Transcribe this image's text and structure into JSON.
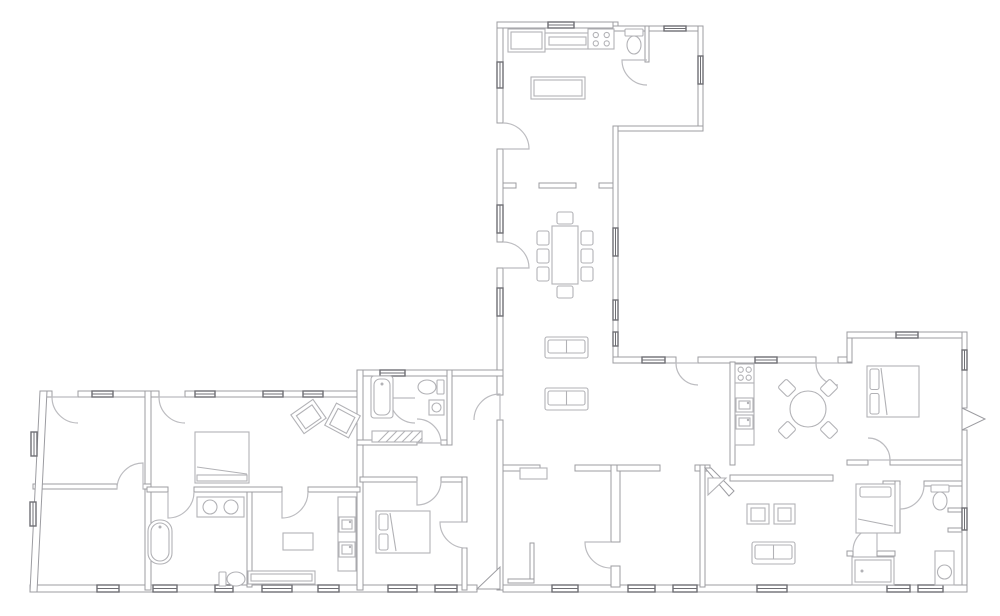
{
  "canvas": {
    "w": 1000,
    "h": 616,
    "bg": "#ffffff"
  },
  "style": {
    "wall_stroke": "#9c9ca1",
    "wall_fill": "#ffffff",
    "window_stroke": "#6f6f74",
    "door_stroke": "#bcbcc0",
    "furn_stroke": "#b2b2b6",
    "furn_fill": "#ffffff"
  },
  "walls": [
    {
      "x": 497,
      "y": 22,
      "w": 6,
      "h": 101,
      "n": "wing-left-a"
    },
    {
      "x": 497,
      "y": 149,
      "w": 6,
      "h": 93,
      "n": "wing-left-b"
    },
    {
      "x": 497,
      "y": 268,
      "w": 6,
      "h": 127,
      "n": "wing-left-c"
    },
    {
      "x": 497,
      "y": 420,
      "w": 6,
      "h": 170,
      "n": "wing-left-d"
    },
    {
      "x": 497,
      "y": 22,
      "w": 121,
      "h": 6,
      "n": "kitchen-top"
    },
    {
      "x": 613,
      "y": 22,
      "w": 5,
      "h": 9,
      "n": "kitchen-right-stub"
    },
    {
      "x": 613,
      "y": 26,
      "w": 90,
      "h": 5,
      "n": "annex-top"
    },
    {
      "x": 698,
      "y": 26,
      "w": 5,
      "h": 105,
      "n": "annex-right"
    },
    {
      "x": 613,
      "y": 126,
      "w": 90,
      "h": 5,
      "n": "annex-bottom"
    },
    {
      "x": 613,
      "y": 126,
      "w": 5,
      "h": 236,
      "n": "wing-right"
    },
    {
      "x": 613,
      "y": 357,
      "w": 63,
      "h": 6,
      "n": "rwing-top-a"
    },
    {
      "x": 698,
      "y": 357,
      "w": 118,
      "h": 6,
      "n": "rwing-top-b"
    },
    {
      "x": 838,
      "y": 357,
      "w": 14,
      "h": 6,
      "n": "rwing-top-c"
    },
    {
      "x": 847,
      "y": 332,
      "w": 5,
      "h": 30,
      "n": "tower-left"
    },
    {
      "x": 847,
      "y": 332,
      "w": 120,
      "h": 6,
      "n": "tower-top"
    },
    {
      "x": 962,
      "y": 332,
      "w": 5,
      "h": 76,
      "n": "tower-right-a"
    },
    {
      "x": 962,
      "y": 430,
      "w": 5,
      "h": 160,
      "n": "tower-right-b"
    },
    {
      "x": 30,
      "y": 585,
      "w": 447,
      "h": 7,
      "n": "bottom-wall-a"
    },
    {
      "x": 503,
      "y": 585,
      "w": 464,
      "h": 7,
      "n": "bottom-wall-b"
    },
    {
      "x": 40,
      "y": 391,
      "w": 12,
      "h": 6,
      "n": "lwing-top-a"
    },
    {
      "x": 78,
      "y": 391,
      "w": 81,
      "h": 6,
      "n": "lwing-top-b"
    },
    {
      "x": 185,
      "y": 391,
      "w": 175,
      "h": 6,
      "n": "lwing-top-c"
    },
    {
      "x": 357,
      "y": 370,
      "w": 146,
      "h": 6,
      "n": "mid-top"
    },
    {
      "x": 357,
      "y": 370,
      "w": 6,
      "h": 220,
      "n": "mid-vert"
    },
    {
      "x": 503,
      "y": 183,
      "w": 13,
      "h": 5,
      "n": "kitchen-dining-a"
    },
    {
      "x": 539,
      "y": 183,
      "w": 37,
      "h": 5,
      "n": "kitchen-dining-b"
    },
    {
      "x": 599,
      "y": 183,
      "w": 14,
      "h": 5,
      "n": "kitchen-dining-c"
    },
    {
      "x": 645,
      "y": 26,
      "w": 4,
      "h": 36,
      "n": "wc-partition"
    },
    {
      "x": 357,
      "y": 440,
      "w": 60,
      "h": 5,
      "n": "bath1-bottom-a"
    },
    {
      "x": 441,
      "y": 440,
      "w": 11,
      "h": 5,
      "n": "bath1-bottom-b"
    },
    {
      "x": 447,
      "y": 370,
      "w": 5,
      "h": 75,
      "n": "bath1-right"
    },
    {
      "x": 145,
      "y": 391,
      "w": 6,
      "h": 199,
      "n": "lwing-mid-vert"
    },
    {
      "x": 33,
      "y": 484,
      "w": 84,
      "h": 5,
      "n": "left-partition-a"
    },
    {
      "x": 143,
      "y": 484,
      "w": 8,
      "h": 5,
      "n": "left-partition-b"
    },
    {
      "x": 247,
      "y": 492,
      "w": 5,
      "h": 95,
      "n": "bath-utility-divider"
    },
    {
      "x": 147,
      "y": 487,
      "w": 21,
      "h": 5,
      "n": "partition487-a"
    },
    {
      "x": 194,
      "y": 487,
      "w": 88,
      "h": 5,
      "n": "partition487-b"
    },
    {
      "x": 308,
      "y": 487,
      "w": 52,
      "h": 5,
      "n": "partition487-c"
    },
    {
      "x": 360,
      "y": 477,
      "w": 57,
      "h": 5,
      "n": "bedroom2-top-a"
    },
    {
      "x": 441,
      "y": 477,
      "w": 25,
      "h": 5,
      "n": "bedroom2-top-b"
    },
    {
      "x": 462,
      "y": 477,
      "w": 5,
      "h": 45,
      "n": "bedroom2-right-a"
    },
    {
      "x": 462,
      "y": 548,
      "w": 5,
      "h": 42,
      "n": "bedroom2-right-b"
    },
    {
      "x": 503,
      "y": 465,
      "w": 37,
      "h": 6,
      "n": "roomA-top-a"
    },
    {
      "x": 575,
      "y": 465,
      "w": 42,
      "h": 6,
      "n": "roomA-top-b"
    },
    {
      "x": 611,
      "y": 465,
      "w": 9,
      "h": 77,
      "n": "roomA-right-a"
    },
    {
      "x": 611,
      "y": 566,
      "w": 9,
      "h": 21,
      "n": "roomA-right-b"
    },
    {
      "x": 617,
      "y": 465,
      "w": 43,
      "h": 6,
      "n": "roomB-top-a"
    },
    {
      "x": 695,
      "y": 465,
      "w": 15,
      "h": 6,
      "n": "roomB-top-b"
    },
    {
      "x": 700,
      "y": 465,
      "w": 5,
      "h": 122,
      "n": "roomB-right"
    },
    {
      "x": 730,
      "y": 362,
      "w": 5,
      "h": 103,
      "n": "kitchen2-left"
    },
    {
      "x": 730,
      "y": 475,
      "w": 103,
      "h": 6,
      "n": "living-top"
    },
    {
      "x": 847,
      "y": 460,
      "w": 21,
      "h": 5,
      "n": "tower-hall-a"
    },
    {
      "x": 890,
      "y": 460,
      "w": 72,
      "h": 5,
      "n": "tower-hall-b"
    },
    {
      "x": 883,
      "y": 481,
      "w": 17,
      "h": 5,
      "n": "bedroom3-top"
    },
    {
      "x": 924,
      "y": 481,
      "w": 38,
      "h": 5,
      "n": "suite-top"
    },
    {
      "x": 895,
      "y": 481,
      "w": 5,
      "h": 52,
      "n": "bedroom3-right"
    },
    {
      "x": 847,
      "y": 551,
      "w": 6,
      "h": 5,
      "n": "suite-mid-a"
    },
    {
      "x": 877,
      "y": 551,
      "w": 18,
      "h": 5,
      "n": "suite-mid-b"
    },
    {
      "x": 948,
      "y": 508,
      "w": 14,
      "h": 4,
      "n": "niche-a"
    },
    {
      "x": 948,
      "y": 528,
      "w": 14,
      "h": 4,
      "n": "niche-b"
    },
    {
      "x": 530,
      "y": 543,
      "w": 4,
      "h": 40,
      "n": "roomA-closet-a"
    },
    {
      "x": 508,
      "y": 579,
      "w": 26,
      "h": 4,
      "n": "roomA-closet-b"
    }
  ],
  "poly_walls": [
    {
      "points": "40,391 47,391 37,592 30,592",
      "n": "left-slanted-wall"
    },
    {
      "points": "705,468 711,468 734,491 729,496",
      "n": "living-diagonal-wall"
    }
  ],
  "windows": [
    [
      497,
      62,
      6,
      26
    ],
    [
      497,
      205,
      6,
      28
    ],
    [
      497,
      288,
      6,
      28
    ],
    [
      613,
      228,
      5,
      28
    ],
    [
      613,
      300,
      5,
      20
    ],
    [
      613,
      332,
      5,
      14
    ],
    [
      548,
      22,
      26,
      6
    ],
    [
      664,
      26,
      22,
      5
    ],
    [
      698,
      56,
      5,
      28
    ],
    [
      92,
      391,
      21,
      6
    ],
    [
      195,
      391,
      20,
      6
    ],
    [
      263,
      391,
      20,
      6
    ],
    [
      303,
      391,
      20,
      6
    ],
    [
      380,
      370,
      25,
      6
    ],
    [
      642,
      357,
      23,
      6
    ],
    [
      755,
      357,
      22,
      6
    ],
    [
      896,
      332,
      22,
      6
    ],
    [
      962,
      350,
      5,
      20
    ],
    [
      962,
      508,
      5,
      22
    ],
    [
      31,
      432,
      6,
      24
    ],
    [
      30,
      502,
      6,
      24
    ],
    [
      97,
      585,
      22,
      7
    ],
    [
      153,
      585,
      24,
      7
    ],
    [
      215,
      585,
      18,
      7
    ],
    [
      262,
      585,
      30,
      7
    ],
    [
      318,
      585,
      21,
      7
    ],
    [
      388,
      585,
      29,
      7
    ],
    [
      435,
      585,
      22,
      7
    ],
    [
      552,
      585,
      26,
      7
    ],
    [
      628,
      585,
      27,
      7
    ],
    [
      673,
      585,
      24,
      7
    ],
    [
      757,
      585,
      30,
      7
    ],
    [
      887,
      585,
      23,
      7
    ],
    [
      918,
      585,
      25,
      7
    ]
  ],
  "doors": [
    [
      503,
      149,
      26,
      -90,
      0
    ],
    [
      503,
      268,
      26,
      -90,
      0
    ],
    [
      647,
      60,
      25,
      90,
      180
    ],
    [
      698,
      363,
      22,
      90,
      180
    ],
    [
      838,
      363,
      22,
      90,
      180
    ],
    [
      868,
      460,
      22,
      -90,
      0
    ],
    [
      78,
      397,
      26,
      90,
      180
    ],
    [
      185,
      397,
      26,
      90,
      180
    ],
    [
      143,
      489,
      26,
      180,
      270
    ],
    [
      168,
      492,
      26,
      0,
      90
    ],
    [
      282,
      492,
      26,
      0,
      90
    ],
    [
      415,
      398,
      25,
      90,
      180
    ],
    [
      417,
      443,
      24,
      -90,
      0
    ],
    [
      417,
      481,
      24,
      0,
      90
    ],
    [
      466,
      522,
      26,
      90,
      180
    ],
    [
      611,
      542,
      26,
      90,
      180
    ],
    [
      877,
      551,
      24,
      180,
      270
    ],
    [
      900,
      485,
      24,
      0,
      90
    ],
    [
      500,
      420,
      26,
      180,
      270
    ]
  ],
  "wedge_doors": [
    {
      "points": "962,408 985,419 962,430",
      "n": "exterior-door-east"
    },
    {
      "points": "477,589 500,567 500,589",
      "n": "entrance-door-south"
    }
  ],
  "furniture": [
    {
      "shape": "rect",
      "name": "kitchen-counter",
      "x": 508,
      "y": 29,
      "w": 37,
      "h": 23,
      "inner": 3
    },
    {
      "shape": "rect",
      "name": "range-hood",
      "x": 545,
      "y": 33,
      "w": 45,
      "h": 16,
      "inner": 4
    },
    {
      "shape": "hob",
      "name": "cooktop",
      "x": 588,
      "y": 29,
      "w": 26,
      "h": 20
    },
    {
      "shape": "rect",
      "name": "kitchen-island",
      "x": 531,
      "y": 77,
      "w": 54,
      "h": 22,
      "inner": 3
    },
    {
      "shape": "toilet",
      "name": "toilet-wc",
      "x": 634,
      "y": 45,
      "dir": "down"
    },
    {
      "shape": "dining",
      "name": "dining-table",
      "x": 552,
      "y": 226,
      "w": 26,
      "h": 58
    },
    {
      "shape": "sofa",
      "name": "sofa-1",
      "x": 545,
      "y": 337,
      "w": 43,
      "h": 21
    },
    {
      "shape": "sofa",
      "name": "sofa-2",
      "x": 545,
      "y": 388,
      "w": 43,
      "h": 22
    },
    {
      "shape": "bed",
      "name": "double-bed-west",
      "x": 195,
      "y": 432,
      "w": 54,
      "h": 51,
      "pillow": "none",
      "foot": true
    },
    {
      "shape": "chair",
      "name": "armchair-west-1",
      "x": 295,
      "y": 405,
      "w": 27,
      "h": 23,
      "rot": -35
    },
    {
      "shape": "chair",
      "name": "armchair-west-2",
      "x": 329,
      "y": 408,
      "w": 27,
      "h": 25,
      "rot": 28
    },
    {
      "shape": "tubfree",
      "name": "freestanding-bathtub",
      "x": 148,
      "y": 520,
      "w": 24,
      "h": 44
    },
    {
      "shape": "vanity2",
      "name": "double-vanity",
      "x": 197,
      "y": 497,
      "w": 47,
      "h": 20
    },
    {
      "shape": "toilet",
      "name": "toilet-west",
      "x": 236,
      "y": 579,
      "dir": "right"
    },
    {
      "shape": "rect",
      "name": "utility-table",
      "x": 283,
      "y": 533,
      "w": 30,
      "h": 17,
      "inner": 0
    },
    {
      "shape": "rect",
      "name": "utility-counter",
      "x": 338,
      "y": 497,
      "w": 18,
      "h": 74,
      "inner": 0
    },
    {
      "shape": "appliance",
      "name": "appliance-1",
      "x": 339,
      "y": 517,
      "w": 16,
      "h": 15
    },
    {
      "shape": "appliance",
      "name": "appliance-2",
      "x": 339,
      "y": 542,
      "w": 16,
      "h": 15
    },
    {
      "shape": "rect",
      "name": "bench",
      "x": 248,
      "y": 571,
      "w": 67,
      "h": 13,
      "inner": 3
    },
    {
      "shape": "tubbuilt",
      "name": "bathtub-central",
      "x": 371,
      "y": 376,
      "w": 22,
      "h": 42
    },
    {
      "shape": "toilet",
      "name": "toilet-central",
      "x": 427,
      "y": 387,
      "dir": "left"
    },
    {
      "shape": "sink",
      "name": "sink-central",
      "x": 429,
      "y": 400,
      "w": 15,
      "h": 15
    },
    {
      "shape": "hatch",
      "name": "shower-mat",
      "x": 372,
      "y": 431,
      "w": 50,
      "h": 11
    },
    {
      "shape": "bed",
      "name": "double-bed-south",
      "x": 376,
      "y": 511,
      "w": 54,
      "h": 42,
      "pillow": "left"
    },
    {
      "shape": "rect",
      "name": "cabinet-roomA",
      "x": 520,
      "y": 468,
      "w": 27,
      "h": 11,
      "inner": 0
    },
    {
      "shape": "hob",
      "name": "cooktop-2",
      "x": 735,
      "y": 364,
      "w": 19,
      "h": 19
    },
    {
      "shape": "rect",
      "name": "counter-2",
      "x": 735,
      "y": 383,
      "w": 19,
      "h": 62,
      "inner": 0
    },
    {
      "shape": "appliance",
      "name": "sink-unit-1",
      "x": 736,
      "y": 398,
      "w": 17,
      "h": 14
    },
    {
      "shape": "appliance",
      "name": "sink-unit-2",
      "x": 736,
      "y": 415,
      "w": 17,
      "h": 14
    },
    {
      "shape": "roundtable",
      "name": "round-dining-table",
      "x": 808,
      "y": 409,
      "r": 18
    },
    {
      "shape": "chair",
      "name": "armchair-east-1",
      "x": 747,
      "y": 504,
      "w": 22,
      "h": 20,
      "rot": 0
    },
    {
      "shape": "chair",
      "name": "armchair-east-2",
      "x": 774,
      "y": 504,
      "w": 21,
      "h": 20,
      "rot": 0
    },
    {
      "shape": "sofa",
      "name": "sofa-east",
      "x": 752,
      "y": 542,
      "w": 43,
      "h": 22
    },
    {
      "shape": "tri",
      "name": "corner-unit",
      "points": "708,478 726,478 708,495"
    },
    {
      "shape": "bed",
      "name": "double-bed-tower",
      "x": 867,
      "y": 366,
      "w": 52,
      "h": 51,
      "pillow": "left"
    },
    {
      "shape": "bed",
      "name": "single-bed",
      "x": 856,
      "y": 484,
      "w": 39,
      "h": 49,
      "pillow": "top"
    },
    {
      "shape": "toilet",
      "name": "toilet-east",
      "x": 940,
      "y": 501,
      "dir": "down"
    },
    {
      "shape": "vanityunit",
      "name": "shower-vanity",
      "x": 935,
      "y": 551,
      "w": 19,
      "h": 34
    },
    {
      "shape": "rect",
      "name": "built-in-bathtub",
      "x": 852,
      "y": 557,
      "w": 42,
      "h": 28,
      "inner": 3,
      "dot": true
    }
  ]
}
